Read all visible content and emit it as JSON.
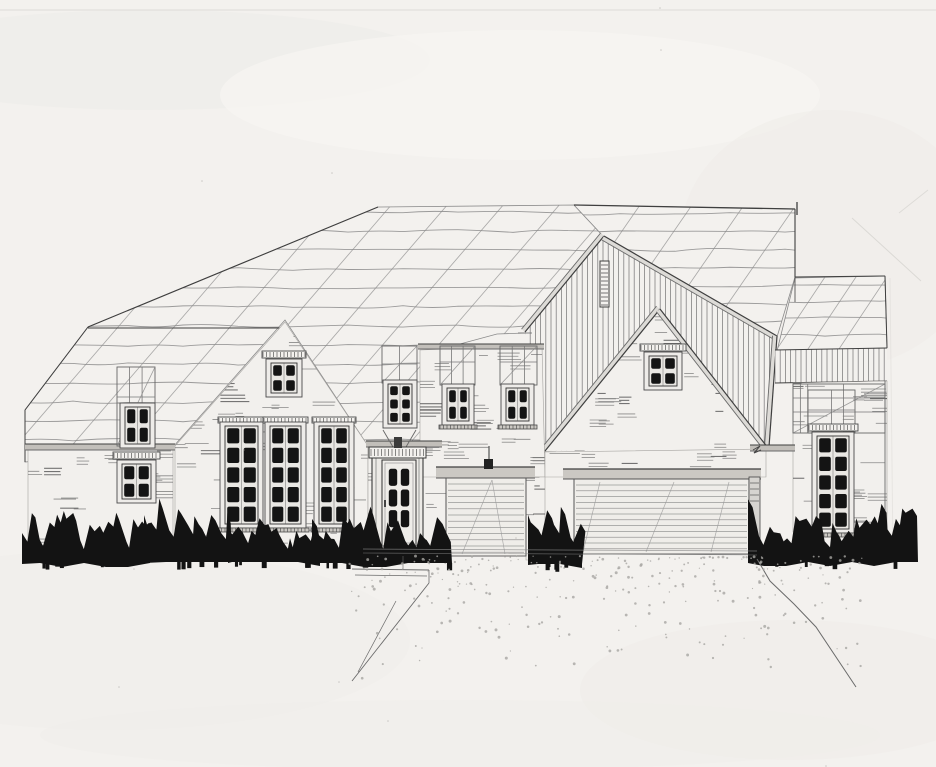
{
  "meta": {
    "description": "Hand-drawn architectural front elevation sketch of a single-family house with entry door, three-car garage, board-and-batten gables and ink-filled shrubs",
    "medium": "pencil and ink on paper"
  },
  "palette": {
    "paper": "#f3f1ee",
    "paper_shade": "#eceae6",
    "paper_light": "#f8f7f4",
    "pencil": "#8b8b8b",
    "pencil_soft": "#a5a3a0",
    "line_med": "#6a6a6a",
    "line_dark": "#3f3f3f",
    "ink": "#2d2d2d",
    "glass": "#141414",
    "fascia": "#c2bfba",
    "fascia_light": "#dddbd7",
    "header_beam": "#cbc8c3",
    "stipple": "#a8a6a2",
    "faint": "#d9d7d3",
    "wallfill": "#f2f0ed",
    "glassbg": "#e9e7e3"
  },
  "scene": {
    "w": 936,
    "h": 767,
    "paper_blobs": [
      [
        150,
        60,
        280,
        50,
        "#eceae6",
        0.45
      ],
      [
        520,
        95,
        300,
        65,
        "#f8f7f4",
        0.6
      ],
      [
        830,
        240,
        150,
        130,
        "#edebe7",
        0.4
      ],
      [
        110,
        640,
        300,
        90,
        "#efede9",
        0.5
      ],
      [
        790,
        690,
        210,
        70,
        "#edebe7",
        0.4
      ],
      [
        460,
        735,
        420,
        35,
        "#f0eeea",
        0.5
      ]
    ],
    "faint_lines": [
      [
        0,
        10,
        936,
        10,
        0.8
      ],
      [
        852,
        218,
        921,
        281,
        0.9
      ],
      [
        928,
        190,
        899,
        213,
        0.8
      ],
      [
        890,
        278,
        893,
        555,
        0.45
      ],
      [
        88,
        327,
        40,
        392,
        0.5
      ]
    ],
    "roofs": [
      {
        "name": "roof-main-left",
        "poly": [
          [
            378,
            207
          ],
          [
            574,
            205
          ],
          [
            604,
            237
          ],
          [
            525,
            333
          ],
          [
            497,
            334
          ],
          [
            445,
            348
          ],
          [
            445,
            443
          ],
          [
            368,
            446
          ],
          [
            285,
            320
          ],
          [
            173,
            447
          ],
          [
            25,
            462
          ],
          [
            25,
            410
          ],
          [
            88,
            327
          ]
        ],
        "wavy": {
          "y0": 212,
          "y1": 458,
          "sp": 19,
          "x0": 18,
          "x1": 615
        },
        "diag": {
          "xs": 175,
          "xe": 665,
          "step": 56,
          "slope": 1.16,
          "len": 430,
          "ytop": 196
        },
        "edges": [
          [
            88,
            327,
            378,
            207,
            1.1
          ],
          [
            25,
            410,
            88,
            327,
            1.0
          ],
          [
            25,
            410,
            25,
            462,
            1.0
          ],
          [
            88,
            328,
            284,
            328,
            0.9
          ],
          [
            445,
            349,
            445,
            443,
            0.8
          ]
        ]
      },
      {
        "name": "roof-main-right",
        "poly": [
          [
            574,
            205
          ],
          [
            795,
            209
          ],
          [
            795,
            277
          ],
          [
            777,
            337
          ],
          [
            604,
            237
          ]
        ],
        "wavy": {
          "y0": 214,
          "y1": 338,
          "sp": 18,
          "x0": 565,
          "x1": 802
        },
        "diag": {
          "xs": 640,
          "xe": 805,
          "step": 52,
          "slope": 1.45,
          "len": 270,
          "ytop": 205
        },
        "edges": [
          [
            574,
            205,
            795,
            209,
            1.3
          ],
          [
            795,
            209,
            795,
            277,
            1.1
          ],
          [
            797,
            202,
            797,
            215,
            1.3
          ]
        ]
      },
      {
        "name": "roof-right-wing",
        "poly": [
          [
            795,
            278
          ],
          [
            885,
            276
          ],
          [
            887,
            348
          ],
          [
            777,
            351
          ]
        ],
        "wavy": {
          "y0": 284,
          "y1": 350,
          "sp": 17,
          "x0": 770,
          "x1": 895
        },
        "diag": {
          "xs": 800,
          "xe": 905,
          "step": 31,
          "slope": 1.5,
          "len": 130,
          "ytop": 268
        },
        "edges": [
          [
            795,
            277,
            885,
            276,
            1.1
          ],
          [
            885,
            276,
            887,
            348,
            1.0
          ],
          [
            795,
            277,
            795,
            302,
            0.8
          ]
        ]
      }
    ],
    "board_batten": {
      "name": "front-gable-board-batten",
      "poly": [
        [
          604,
          236
        ],
        [
          777,
          336
        ],
        [
          769,
          447
        ],
        [
          545,
          451
        ],
        [
          525,
          332
        ]
      ],
      "vsp": 5.2,
      "fascia": [
        [
          604,
          236,
          525,
          332
        ],
        [
          604,
          236,
          777,
          336
        ],
        [
          777,
          336,
          769,
          447
        ]
      ],
      "louver": [
        600,
        261,
        9,
        46
      ]
    },
    "siding_band": {
      "name": "right-wing-siding-band",
      "poly": [
        [
          775,
          350
        ],
        [
          887,
          348
        ],
        [
          887,
          381
        ],
        [
          775,
          383
        ]
      ],
      "vsp": 5.2,
      "edges": [
        [
          775,
          350,
          887,
          348,
          1.0
        ],
        [
          775,
          383,
          887,
          381,
          1.0
        ]
      ]
    },
    "inner_gable": {
      "name": "garage-brick-gable",
      "poly": [
        [
          660,
          309
        ],
        [
          545,
          451
        ],
        [
          768,
          448
        ]
      ],
      "fascia": [
        [
          660,
          309,
          545,
          451
        ],
        [
          660,
          309,
          768,
          448
        ]
      ],
      "returns": [
        [
          533,
          452,
          556,
          452
        ],
        [
          760,
          449,
          778,
          448
        ]
      ],
      "hatch": 36
    },
    "walls": [
      {
        "name": "wall-left-wing",
        "poly": [
          [
            28,
            447
          ],
          [
            173,
            447
          ],
          [
            173,
            557
          ],
          [
            28,
            557
          ]
        ],
        "hatch": 26
      },
      {
        "name": "wall-left-gable",
        "poly": [
          [
            285,
            322
          ],
          [
            368,
            446
          ],
          [
            368,
            556
          ],
          [
            175,
            556
          ],
          [
            175,
            446
          ]
        ],
        "hatch": 46
      },
      {
        "name": "wall-entry-bay",
        "poly": [
          [
            368,
            446
          ],
          [
            446,
            446
          ],
          [
            446,
            556
          ],
          [
            368,
            556
          ]
        ],
        "hatch": 10
      },
      {
        "name": "wall-center",
        "poly": [
          [
            420,
            350
          ],
          [
            542,
            346
          ],
          [
            545,
            477
          ],
          [
            420,
            477
          ]
        ],
        "hatch": 28
      },
      {
        "name": "wall-garage-pier",
        "poly": [
          [
            526,
            477
          ],
          [
            545,
            477
          ],
          [
            545,
            560
          ],
          [
            526,
            560
          ]
        ],
        "hatch": 4
      },
      {
        "name": "wall-garage-strip",
        "poly": [
          [
            545,
            452
          ],
          [
            766,
            449
          ],
          [
            766,
            477
          ],
          [
            545,
            477
          ]
        ],
        "hatch": 14
      },
      {
        "name": "wall-right-wing",
        "poly": [
          [
            793,
            383
          ],
          [
            887,
            381
          ],
          [
            887,
            532
          ],
          [
            793,
            532
          ]
        ],
        "hatch": 26
      }
    ],
    "eaves": [
      [
        25,
        444,
        150,
        6
      ],
      [
        366,
        441,
        76,
        6
      ],
      [
        418,
        344,
        126,
        5
      ],
      [
        750,
        445,
        45,
        6
      ]
    ],
    "trellises": [
      {
        "name": "frame-left-wing",
        "x": 117,
        "y": 367,
        "w": 38,
        "h": 79,
        "v": [
          0.33,
          0.66
        ],
        "bands": [
          30,
          36
        ],
        "diag": true
      },
      {
        "name": "frame-entry",
        "x": 382,
        "y": 346,
        "w": 35,
        "h": 37,
        "v": [
          0.5
        ],
        "bands": [
          18
        ],
        "diag": true
      },
      {
        "name": "frame-center-a",
        "x": 440,
        "y": 346,
        "w": 35,
        "h": 39,
        "v": [
          0.33,
          0.66
        ],
        "bands": [
          16
        ],
        "diag": true
      },
      {
        "name": "frame-center-b",
        "x": 500,
        "y": 346,
        "w": 37,
        "h": 39,
        "v": [
          0.33,
          0.66
        ],
        "bands": [
          16
        ],
        "diag": true
      },
      {
        "name": "frame-right-outer",
        "x": 793,
        "y": 384,
        "w": 92,
        "h": 49,
        "v": [
          0.08,
          0.16,
          0.55
        ],
        "bands": [
          14,
          28
        ],
        "diag": true
      },
      {
        "name": "frame-right-inner",
        "x": 808,
        "y": 390,
        "w": 47,
        "h": 43,
        "v": [
          0.5
        ],
        "bands": [
          20
        ],
        "diag": false
      }
    ],
    "windows": [
      {
        "name": "window-left-wing-upper",
        "x": 125,
        "y": 407,
        "w": 25,
        "h": 37,
        "c": 2,
        "r": 2
      },
      {
        "name": "window-left-wing-lower",
        "x": 122,
        "y": 464,
        "w": 29,
        "h": 35,
        "c": 2,
        "r": 2,
        "cap": true
      },
      {
        "name": "window-left-gable",
        "x": 271,
        "y": 363,
        "w": 26,
        "h": 30,
        "c": 2,
        "r": 2,
        "cap": true
      },
      {
        "name": "window-tall-1",
        "x": 225,
        "y": 426,
        "w": 33,
        "h": 98,
        "c": 2,
        "r": 5,
        "head": true,
        "sill": true
      },
      {
        "name": "window-tall-2",
        "x": 270,
        "y": 426,
        "w": 31,
        "h": 98,
        "c": 2,
        "r": 5,
        "head": true,
        "sill": true
      },
      {
        "name": "window-tall-3",
        "x": 319,
        "y": 426,
        "w": 30,
        "h": 98,
        "c": 2,
        "r": 5,
        "head": true,
        "sill": true
      },
      {
        "name": "window-entry-transom",
        "x": 388,
        "y": 384,
        "w": 24,
        "h": 40,
        "c": 2,
        "r": 3
      },
      {
        "name": "window-center-a",
        "x": 447,
        "y": 388,
        "w": 22,
        "h": 33,
        "c": 2,
        "r": 2,
        "sill": true
      },
      {
        "name": "window-center-b",
        "x": 506,
        "y": 388,
        "w": 23,
        "h": 33,
        "c": 2,
        "r": 2,
        "sill": true
      },
      {
        "name": "window-garage-gable",
        "x": 649,
        "y": 356,
        "w": 28,
        "h": 30,
        "c": 2,
        "r": 2,
        "cap": true
      },
      {
        "name": "window-right-wing",
        "x": 817,
        "y": 436,
        "w": 32,
        "h": 93,
        "c": 2,
        "r": 5,
        "cap": true,
        "sill": true
      }
    ],
    "door": {
      "name": "entry-door",
      "surround": [
        372,
        448,
        51,
        105
      ],
      "dentil": [
        369,
        447,
        57,
        11
      ],
      "finial": [
        394,
        437,
        8,
        11
      ],
      "slab": [
        382,
        460,
        34,
        86
      ],
      "glass": [
        387,
        467,
        24,
        62
      ],
      "c": 2,
      "r": 3,
      "steps": [
        [
          378,
          546,
          42,
          5
        ],
        [
          372,
          552,
          54,
          5
        ]
      ],
      "handle": [
        384,
        500,
        2,
        7
      ],
      "brackets": [
        [
          383,
          430,
          393,
          447
        ],
        [
          416,
          430,
          406,
          447
        ]
      ]
    },
    "garages": [
      {
        "name": "garage-single",
        "header": [
          436,
          467,
          99,
          11
        ],
        "open": [
          446,
          478,
          80,
          78
        ],
        "slat0": 484,
        "slatsp": 6.2,
        "diags": [
          [
            492,
            480,
            462,
            554
          ],
          [
            492,
            480,
            505,
            554
          ]
        ]
      },
      {
        "name": "garage-double",
        "header": [
          563,
          469,
          198,
          10
        ],
        "open": [
          574,
          479,
          175,
          75
        ],
        "slat0": 485,
        "slatsp": 5.8,
        "diags": [
          [
            600,
            482,
            583,
            552
          ],
          [
            674,
            482,
            646,
            552
          ],
          [
            729,
            482,
            711,
            552
          ]
        ],
        "trim": [
          749,
          477,
          11,
          63
        ]
      }
    ],
    "vent_pipe": {
      "stem": [
        489,
        446,
        489,
        459
      ],
      "box": [
        484,
        459,
        9,
        10
      ]
    },
    "z_mark": [
      [
        753,
        450
      ],
      [
        760,
        446
      ],
      [
        754,
        453
      ],
      [
        761,
        450
      ]
    ],
    "outlines": [
      [
        885,
        381,
        885,
        532,
        0.9
      ],
      [
        793,
        383,
        793,
        433,
        0.7
      ],
      [
        518,
        333,
        532,
        333,
        0.8
      ]
    ],
    "bushes": [
      {
        "x0": 22,
        "x1": 150,
        "base": 561,
        "hmin": 18,
        "hmax": 50
      },
      {
        "x0": 144,
        "x1": 232,
        "base": 560,
        "hmin": 20,
        "hmax": 54
      },
      {
        "x0": 228,
        "x1": 320,
        "base": 560,
        "hmin": 14,
        "hmax": 42
      },
      {
        "x0": 312,
        "x1": 452,
        "base": 561,
        "hmin": 16,
        "hmax": 48
      },
      {
        "x0": 528,
        "x1": 582,
        "base": 562,
        "hmin": 22,
        "hmax": 56
      },
      {
        "x0": 748,
        "x1": 918,
        "base": 560,
        "hmin": 18,
        "hmax": 52
      }
    ],
    "ground": {
      "base_lines": [
        [
          363,
          549,
          757,
          551,
          0.7
        ],
        [
          363,
          553,
          757,
          555,
          0.6
        ]
      ],
      "walkway": [
        [
          352,
          569,
          429,
          570,
          0.9
        ],
        [
          355,
          575,
          427,
          576,
          0.7
        ],
        [
          429,
          570,
          429,
          583,
          0.8
        ],
        [
          429,
          583,
          352,
          681,
          0.9
        ],
        [
          396,
          601,
          358,
          672,
          0.7
        ],
        [
          403,
          556,
          403,
          569,
          0.6
        ]
      ],
      "driveway_edge": [
        [
          757,
          559
        ],
        [
          770,
          581
        ],
        [
          794,
          604
        ],
        [
          816,
          627
        ],
        [
          856,
          687
        ]
      ],
      "stipple": {
        "x0": 348,
        "x1": 862,
        "y0": 556,
        "yspread": 135,
        "n": 300
      }
    }
  }
}
